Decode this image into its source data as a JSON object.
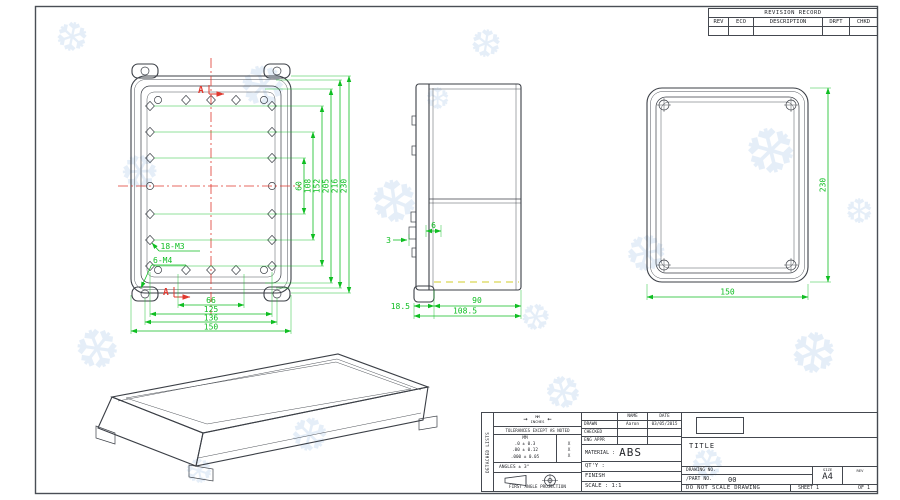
{
  "colors": {
    "dimension_green": "#0fbe22",
    "centerline_red": "#e0382e",
    "hidden_yellow": "#d2cd2a",
    "line_gray": "#3b3f46",
    "watermark_blue": "#dbe8f6"
  },
  "watermark_glyph": "❆",
  "revision_table": {
    "title": "REVISION RECORD",
    "headers": [
      "REV",
      "ECO",
      "DESCRIPTION",
      "DRFT",
      "CHKD"
    ]
  },
  "views": {
    "front": {
      "bolt_label_m3": "18-M3",
      "bolt_label_m4": "6-M4",
      "section_label": "A",
      "dims_vertical": [
        "60",
        "108",
        "152",
        "205",
        "216",
        "230"
      ],
      "dims_bottom": [
        "66",
        "125",
        "136",
        "150"
      ]
    },
    "side": {
      "dim_3": "3",
      "dim_6": "6",
      "dim_18_5": "18.5",
      "dim_90": "90",
      "dim_108_5": "108.5"
    },
    "back": {
      "dim_height": "230",
      "dim_width": "150"
    }
  },
  "title_block": {
    "side_label": "DETACHED LISTS",
    "units_top": "MM",
    "units_bottom": "INCHES",
    "arrow_left": "→",
    "arrow_right": "←",
    "tolerances_note": "TOLERANCES EXCEPT AS NOTED",
    "mm_header": "MM",
    "tolerance_rows": [
      ".0 ± 0.3",
      ".00 ± 0.12",
      ".000 ± 0.05"
    ],
    "tolerance_marks": [
      "X",
      "X",
      "X"
    ],
    "angles_note": "ANGLES ± 3°",
    "projection_note": "FIRST ANGLE PROJECTION",
    "name_header": "NAME",
    "date_header": "DATE",
    "drawn_label": "DRAWN",
    "drawn_name": "Aaron",
    "drawn_date": "03/05/2015",
    "checked_label": "CHECKED",
    "eng_appr_label": "ENG APPR",
    "material_label": "MATERIAL :",
    "material_value": "ABS",
    "qty_label": "QT'Y :",
    "finish_label": "FINISH",
    "scale_label": "SCALE : 1:1",
    "title_label": "TITLE",
    "drawing_no_label": "DRAWING NO.",
    "part_no_label": "/PART  NO.",
    "part_no_value": "00",
    "size_label": "SIZE",
    "size_value": "A4",
    "rev_label": "REV",
    "do_not_scale": "DO NOT SCALE DRAWING",
    "sheet_label": "SHEET 1",
    "of_label": "OF 1"
  }
}
